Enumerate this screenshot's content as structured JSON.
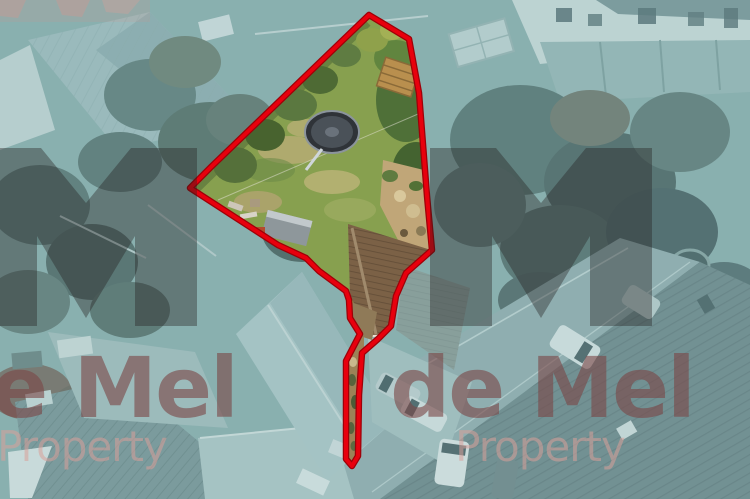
{
  "page": {
    "kind": "aerial-property-photograph",
    "width": 750,
    "height": 499
  },
  "watermark": {
    "brand": "de Mel",
    "subtitle": "Property",
    "brand_color": "#7b4646",
    "subtitle_color": "#d9a09a",
    "icon_color": "#241f20",
    "icon": "m-monogram-logo-icon",
    "instances": 2
  },
  "boundary": {
    "color": "#e8000d",
    "edge_color": "#9e0008",
    "meaning": "plot-for-sale-outline",
    "shape": "garden-polygon-with-access-strip"
  },
  "scene": {
    "tint_color": "#7fa9ab",
    "plot_features": [
      "lawn",
      "trampoline",
      "garden-shed",
      "wood-pallet",
      "patio",
      "house-roof",
      "rear-access-strip"
    ],
    "surroundings": [
      "neighbour-houses",
      "tree-masses",
      "road-with-cars",
      "terraced-roofs",
      "gardens",
      "pond"
    ]
  }
}
